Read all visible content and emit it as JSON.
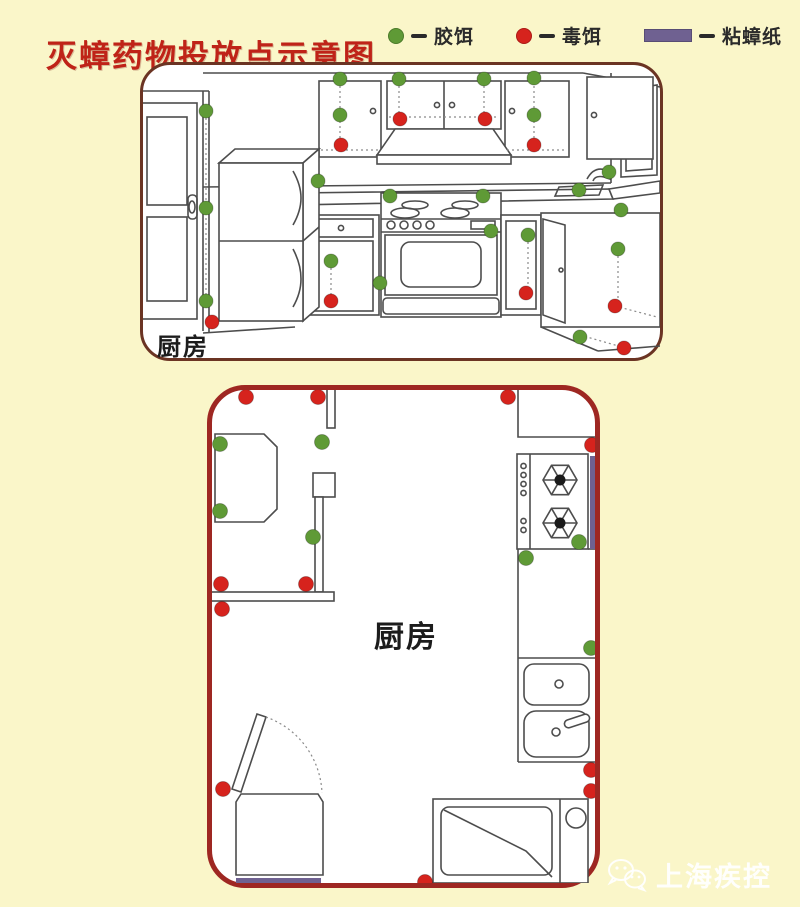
{
  "title": "灭蟑药物投放点示意图",
  "legend": {
    "items": [
      {
        "id": "gel",
        "label": "胶饵",
        "swatch": "dot",
        "color": "#5f9a36"
      },
      {
        "id": "poison",
        "label": "毒饵",
        "swatch": "dot",
        "color": "#d6231d"
      },
      {
        "id": "sticky",
        "label": "粘蟑纸",
        "swatch": "bar",
        "color": "#6f6191"
      }
    ]
  },
  "panels": [
    {
      "id": "kitchen-perspective",
      "label": "厨房",
      "markers": {
        "gel": [
          [
            63,
            46
          ],
          [
            63,
            143
          ],
          [
            63,
            236
          ],
          [
            197,
            14
          ],
          [
            197,
            50
          ],
          [
            256,
            14
          ],
          [
            341,
            14
          ],
          [
            391,
            13
          ],
          [
            391,
            50
          ],
          [
            175,
            116
          ],
          [
            247,
            131
          ],
          [
            340,
            131
          ],
          [
            436,
            125
          ],
          [
            466,
            107
          ],
          [
            478,
            145
          ],
          [
            188,
            196
          ],
          [
            237,
            218
          ],
          [
            348,
            166
          ],
          [
            385,
            170
          ],
          [
            475,
            184
          ],
          [
            437,
            272
          ]
        ],
        "poison": [
          [
            198,
            80
          ],
          [
            257,
            54
          ],
          [
            342,
            54
          ],
          [
            391,
            80
          ],
          [
            69,
            257
          ],
          [
            188,
            236
          ],
          [
            383,
            228
          ],
          [
            472,
            241
          ],
          [
            481,
            283
          ]
        ]
      },
      "sticky_strips": []
    },
    {
      "id": "kitchen-floorplan",
      "label": "厨房",
      "markers": {
        "gel": [
          [
            8,
            54
          ],
          [
            110,
            52
          ],
          [
            8,
            121
          ],
          [
            101,
            147
          ],
          [
            367,
            152
          ],
          [
            314,
            168
          ],
          [
            379,
            258
          ]
        ],
        "poison": [
          [
            34,
            7
          ],
          [
            106,
            7
          ],
          [
            296,
            7
          ],
          [
            380,
            55
          ],
          [
            9,
            194
          ],
          [
            94,
            194
          ],
          [
            10,
            219
          ],
          [
            11,
            399
          ],
          [
            379,
            380
          ],
          [
            379,
            401
          ],
          [
            213,
            492
          ]
        ]
      },
      "sticky_strips": [
        {
          "x": 378,
          "y": 66,
          "w": 9,
          "h": 93
        },
        {
          "x": 24,
          "y": 488,
          "w": 85,
          "h": 7
        }
      ]
    }
  ],
  "watermark": {
    "label": "上海疾控",
    "icon": "wechat-icon"
  },
  "colors": {
    "background": "#faf6c9",
    "title": "#bf2318",
    "panel1_border": "#6b3423",
    "panel2_border": "#9e2722"
  }
}
